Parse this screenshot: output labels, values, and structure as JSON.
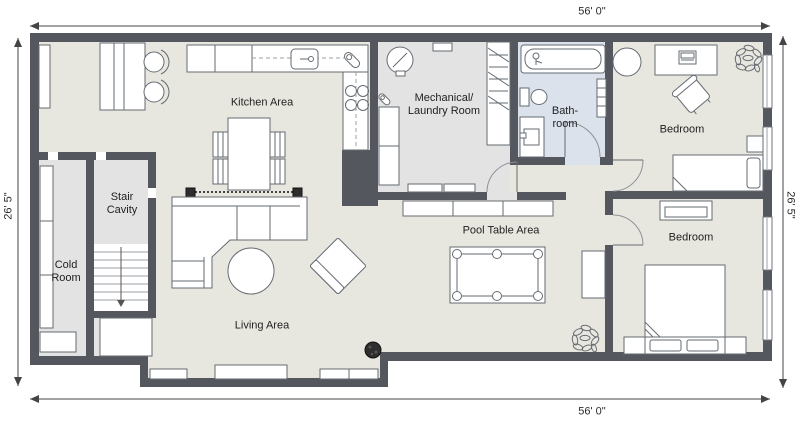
{
  "dimensions": {
    "width_top": "56' 0\"",
    "width_bottom": "56' 0\"",
    "height_left": "26' 5\"",
    "height_right": "26' 5\""
  },
  "rooms": {
    "kitchen": {
      "label": "Kitchen Area"
    },
    "living": {
      "label": "Living Area"
    },
    "pool": {
      "label": "Pool Table Area"
    },
    "mechanical": {
      "line1": "Mechanical/",
      "line2": "Laundry Room"
    },
    "bathroom": {
      "line1": "Bath-",
      "line2": "room"
    },
    "bedroom_top": {
      "label": "Bedroom"
    },
    "bedroom_bottom": {
      "label": "Bedroom"
    },
    "cold": {
      "line1": "Cold",
      "line2": "Room"
    },
    "stair": {
      "line1": "Stair",
      "line2": "Cavity"
    }
  },
  "colors": {
    "wall": "#54585e",
    "floor_main": "#e8e7df",
    "floor_gray": "#e3e3e3",
    "floor_blue": "#dbe2ec"
  }
}
